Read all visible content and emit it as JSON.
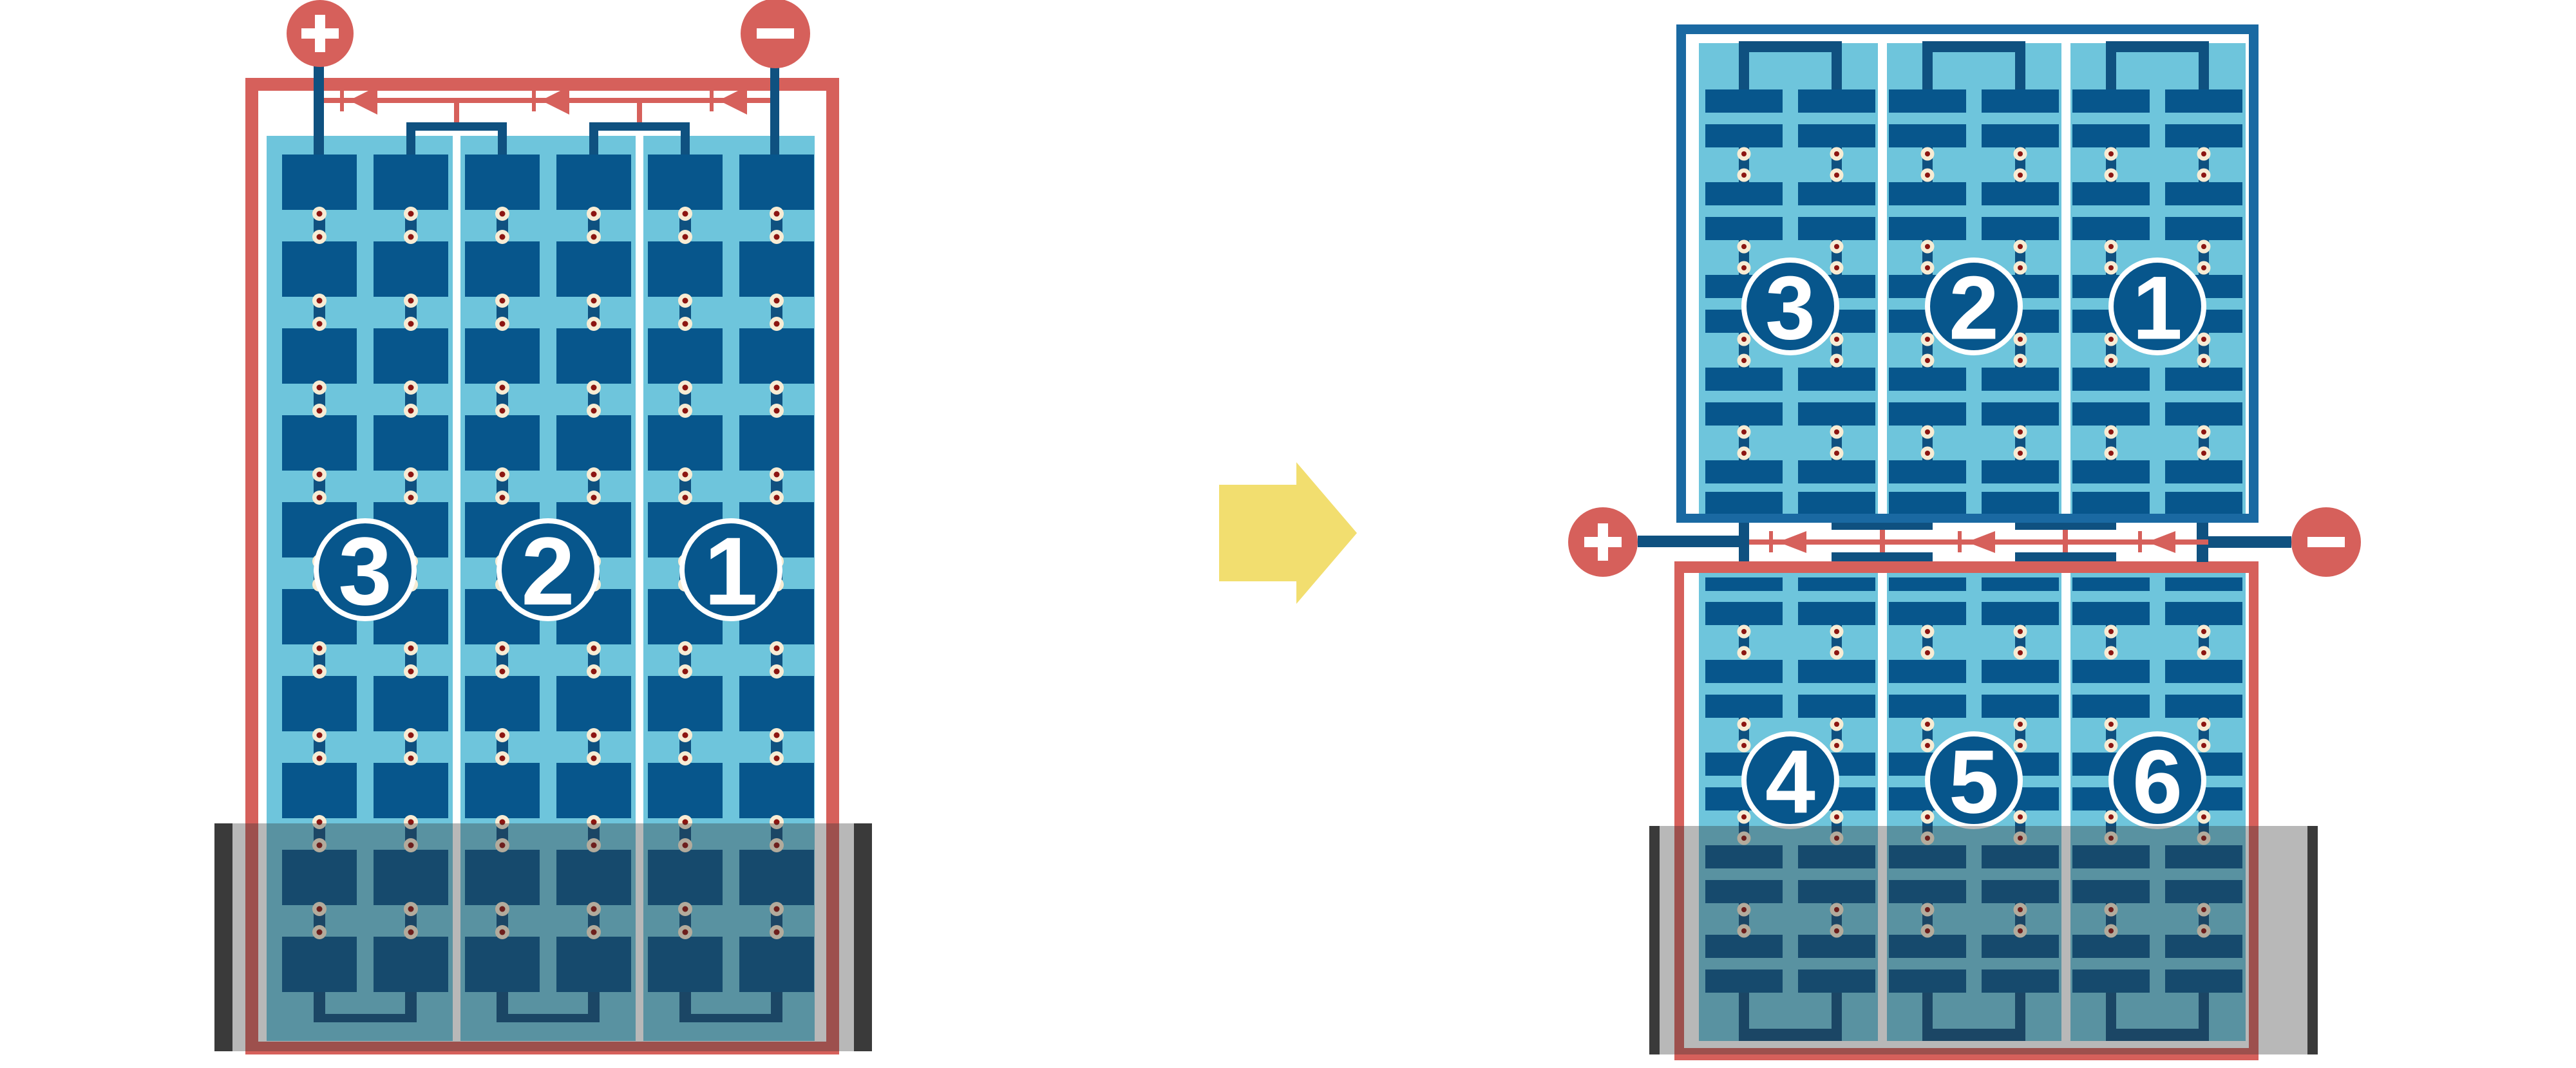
{
  "colors": {
    "red": "#d6605b",
    "navy": "#0f5180",
    "cell": "#07568c",
    "frame_blue": "#1a69a2",
    "light_blue": "#6ec5dc",
    "cream": "#f7ecd4",
    "dot_red": "#8c1511",
    "yellow": "#f2de6f",
    "shade": "rgba(51,51,51,0.35)",
    "shade_bar": "#3a3a3a",
    "white": "#ffffff"
  },
  "left_module": {
    "terminals": {
      "positive": "+",
      "negative": "-"
    },
    "strings": [
      {
        "label": "3"
      },
      {
        "label": "2"
      },
      {
        "label": "1"
      }
    ],
    "cell_grid": {
      "rows": 10,
      "columns": 6
    },
    "bypass_diode_count": 3,
    "shaded_area": "bottom"
  },
  "right_module": {
    "top_half": {
      "strings": [
        {
          "label": "3"
        },
        {
          "label": "2"
        },
        {
          "label": "1"
        }
      ]
    },
    "bottom_half": {
      "strings": [
        {
          "label": "4"
        },
        {
          "label": "5"
        },
        {
          "label": "6"
        }
      ]
    },
    "terminals": {
      "positive": "+",
      "negative": "-"
    },
    "cell_grid": {
      "rows": 10,
      "columns": 6
    },
    "bypass_diode_count": 3,
    "shaded_area": "bottom"
  },
  "transition": {
    "arrow_direction": "right"
  }
}
